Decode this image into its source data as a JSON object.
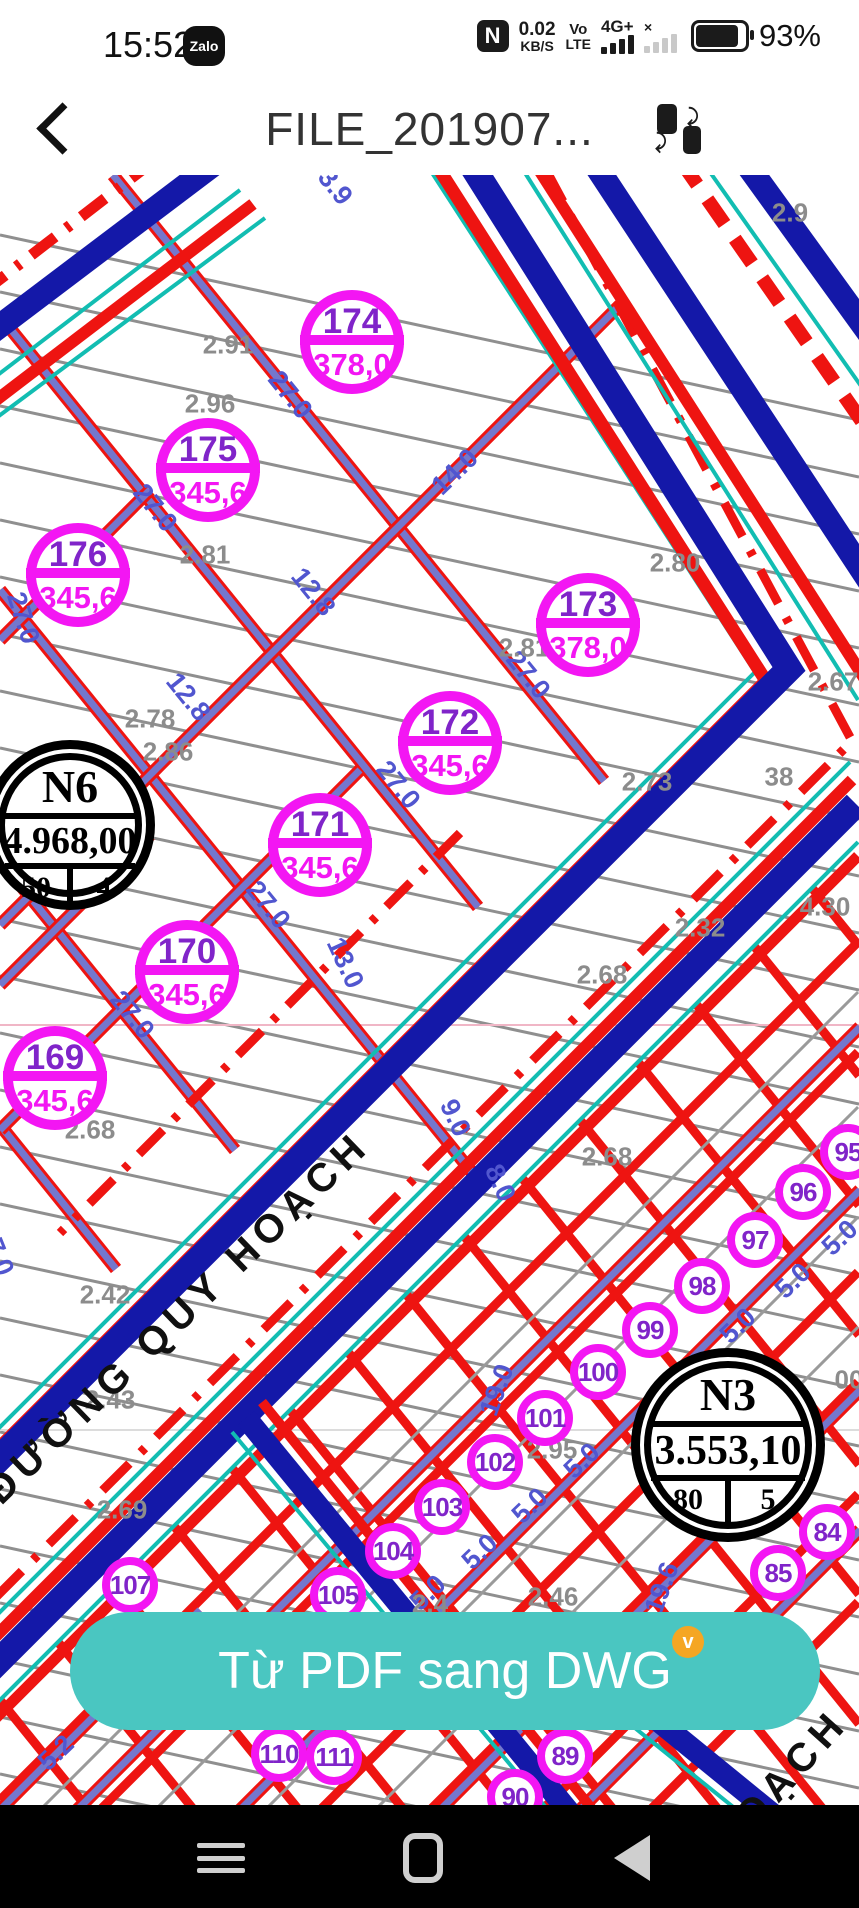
{
  "status_bar": {
    "time": "15:52",
    "zalo_badge": "Zalo",
    "nfc": "N",
    "net_speed_value": "0.02",
    "net_speed_unit": "KB/S",
    "volte_top": "Vo",
    "volte_bottom": "LTE",
    "network_type": "4G+",
    "no_signal_mark": "×",
    "battery_percent": "93%"
  },
  "header": {
    "title": "FILE_201907..."
  },
  "action_button": {
    "label": "Từ PDF sang DWG",
    "badge": "v"
  },
  "map": {
    "road_labels": [
      {
        "text": "ĐƯỜNG QUY HOẠCH",
        "x": 178,
        "y": 1318,
        "rot": -44
      },
      {
        "text": "OẠCH",
        "x": 792,
        "y": 1770,
        "rot": -48
      }
    ],
    "parcels": [
      {
        "id": "174",
        "area": "378,0",
        "x": 352,
        "y": 342,
        "r": 52
      },
      {
        "id": "175",
        "area": "345,6",
        "x": 208,
        "y": 470,
        "r": 52
      },
      {
        "id": "176",
        "area": "345,6",
        "x": 78,
        "y": 575,
        "r": 52
      },
      {
        "id": "173",
        "area": "378,0",
        "x": 588,
        "y": 625,
        "r": 52
      },
      {
        "id": "172",
        "area": "345,6",
        "x": 450,
        "y": 743,
        "r": 52
      },
      {
        "id": "171",
        "area": "345,6",
        "x": 320,
        "y": 845,
        "r": 52
      },
      {
        "id": "170",
        "area": "345,6",
        "x": 187,
        "y": 972,
        "r": 52
      },
      {
        "id": "169",
        "area": "345,6",
        "x": 55,
        "y": 1078,
        "r": 52
      }
    ],
    "lots": [
      {
        "id": "95",
        "x": 848,
        "y": 1152
      },
      {
        "id": "96",
        "x": 803,
        "y": 1192
      },
      {
        "id": "97",
        "x": 755,
        "y": 1240
      },
      {
        "id": "98",
        "x": 702,
        "y": 1286
      },
      {
        "id": "99",
        "x": 650,
        "y": 1330
      },
      {
        "id": "100",
        "x": 598,
        "y": 1372
      },
      {
        "id": "101",
        "x": 545,
        "y": 1418
      },
      {
        "id": "102",
        "x": 495,
        "y": 1462
      },
      {
        "id": "103",
        "x": 442,
        "y": 1507
      },
      {
        "id": "104",
        "x": 393,
        "y": 1551
      },
      {
        "id": "105",
        "x": 338,
        "y": 1595
      },
      {
        "id": "107",
        "x": 130,
        "y": 1585
      },
      {
        "id": "84",
        "x": 827,
        "y": 1532
      },
      {
        "id": "85",
        "x": 778,
        "y": 1573
      },
      {
        "id": "89",
        "x": 565,
        "y": 1756
      },
      {
        "id": "90",
        "x": 515,
        "y": 1797
      },
      {
        "id": "110",
        "x": 279,
        "y": 1754
      },
      {
        "id": "111",
        "x": 334,
        "y": 1757
      }
    ],
    "blocks": [
      {
        "name": "N6",
        "area": "4.968,00",
        "left_val": "50",
        "right_val": "4",
        "x": 70,
        "y": 825,
        "r": 85
      },
      {
        "name": "N3",
        "area": "3.553,10",
        "left_val": "80",
        "right_val": "5",
        "x": 728,
        "y": 1445,
        "r": 97
      }
    ],
    "dims_blue": [
      {
        "text": "27.0",
        "x": 290,
        "y": 395,
        "rot": 51
      },
      {
        "text": "27.0",
        "x": 155,
        "y": 508,
        "rot": 51
      },
      {
        "text": "27.0",
        "x": 23,
        "y": 618,
        "rot": 72
      },
      {
        "text": "27.0",
        "x": 398,
        "y": 785,
        "rot": 51
      },
      {
        "text": "27.0",
        "x": 528,
        "y": 675,
        "rot": 51
      },
      {
        "text": "27.0",
        "x": 132,
        "y": 1015,
        "rot": 51
      },
      {
        "text": "27.0",
        "x": 268,
        "y": 905,
        "rot": 51
      },
      {
        "text": "27.0",
        "x": -4,
        "y": 1250,
        "rot": 68
      },
      {
        "text": "14.0",
        "x": 455,
        "y": 472,
        "rot": -44
      },
      {
        "text": "12.8",
        "x": 313,
        "y": 592,
        "rot": 51
      },
      {
        "text": "12.8",
        "x": 188,
        "y": 697,
        "rot": 51
      },
      {
        "text": "13.0",
        "x": 345,
        "y": 963,
        "rot": 65
      },
      {
        "text": "9.0",
        "x": 455,
        "y": 1118,
        "rot": 65
      },
      {
        "text": "8.0",
        "x": 500,
        "y": 1183,
        "rot": 65
      },
      {
        "text": "3.9",
        "x": 335,
        "y": 187,
        "rot": 51
      },
      {
        "text": "5.0",
        "x": 840,
        "y": 1238,
        "rot": -44
      },
      {
        "text": "5.0",
        "x": 793,
        "y": 1281,
        "rot": -44
      },
      {
        "text": "5.0",
        "x": 738,
        "y": 1326,
        "rot": -44
      },
      {
        "text": "5.0",
        "x": 582,
        "y": 1461,
        "rot": -44
      },
      {
        "text": "5.0",
        "x": 530,
        "y": 1506,
        "rot": -44
      },
      {
        "text": "5.0",
        "x": 480,
        "y": 1552,
        "rot": -44
      },
      {
        "text": "5.0",
        "x": 428,
        "y": 1593,
        "rot": -44
      },
      {
        "text": "19.0",
        "x": 497,
        "y": 1390,
        "rot": -70
      },
      {
        "text": "19.6",
        "x": 662,
        "y": 1588,
        "rot": -70
      },
      {
        "text": "5.2",
        "x": 56,
        "y": 1753,
        "rot": -44
      }
    ],
    "dims_gray": [
      {
        "text": "2.91",
        "x": 228,
        "y": 345
      },
      {
        "text": "2.96",
        "x": 210,
        "y": 404
      },
      {
        "text": "2.81",
        "x": 205,
        "y": 555
      },
      {
        "text": "2.78",
        "x": 150,
        "y": 719
      },
      {
        "text": "2.86",
        "x": 168,
        "y": 752
      },
      {
        "text": "2.68",
        "x": 90,
        "y": 1130
      },
      {
        "text": "2.42",
        "x": 105,
        "y": 1295
      },
      {
        "text": "2.43",
        "x": 110,
        "y": 1400
      },
      {
        "text": "2.69",
        "x": 122,
        "y": 1510
      },
      {
        "text": "2.81",
        "x": 524,
        "y": 648
      },
      {
        "text": "2.80",
        "x": 675,
        "y": 563
      },
      {
        "text": "2.67",
        "x": 833,
        "y": 682
      },
      {
        "text": "2.73",
        "x": 647,
        "y": 782
      },
      {
        "text": "38",
        "x": 779,
        "y": 777
      },
      {
        "text": "2.32",
        "x": 700,
        "y": 928
      },
      {
        "text": "2.68",
        "x": 602,
        "y": 975
      },
      {
        "text": "4.30",
        "x": 825,
        "y": 907
      },
      {
        "text": "2.68",
        "x": 607,
        "y": 1157
      },
      {
        "text": "00",
        "x": 849,
        "y": 1380
      },
      {
        "text": "2.95",
        "x": 552,
        "y": 1450
      },
      {
        "text": "2.46",
        "x": 553,
        "y": 1597
      },
      {
        "text": "2.4",
        "x": 430,
        "y": 1604
      },
      {
        "text": "2.9",
        "x": 790,
        "y": 213
      }
    ],
    "colors": {
      "magenta": "#f316f3",
      "parcel_number": "#8024c9",
      "blue_road": "#1418a8",
      "teal": "#12bdb2",
      "red": "#ee1411",
      "street": "#7477cd",
      "gray_line": "#8f8f8f",
      "dim_blue": "#5156cf",
      "button_teal": "#4ac6c1"
    }
  }
}
